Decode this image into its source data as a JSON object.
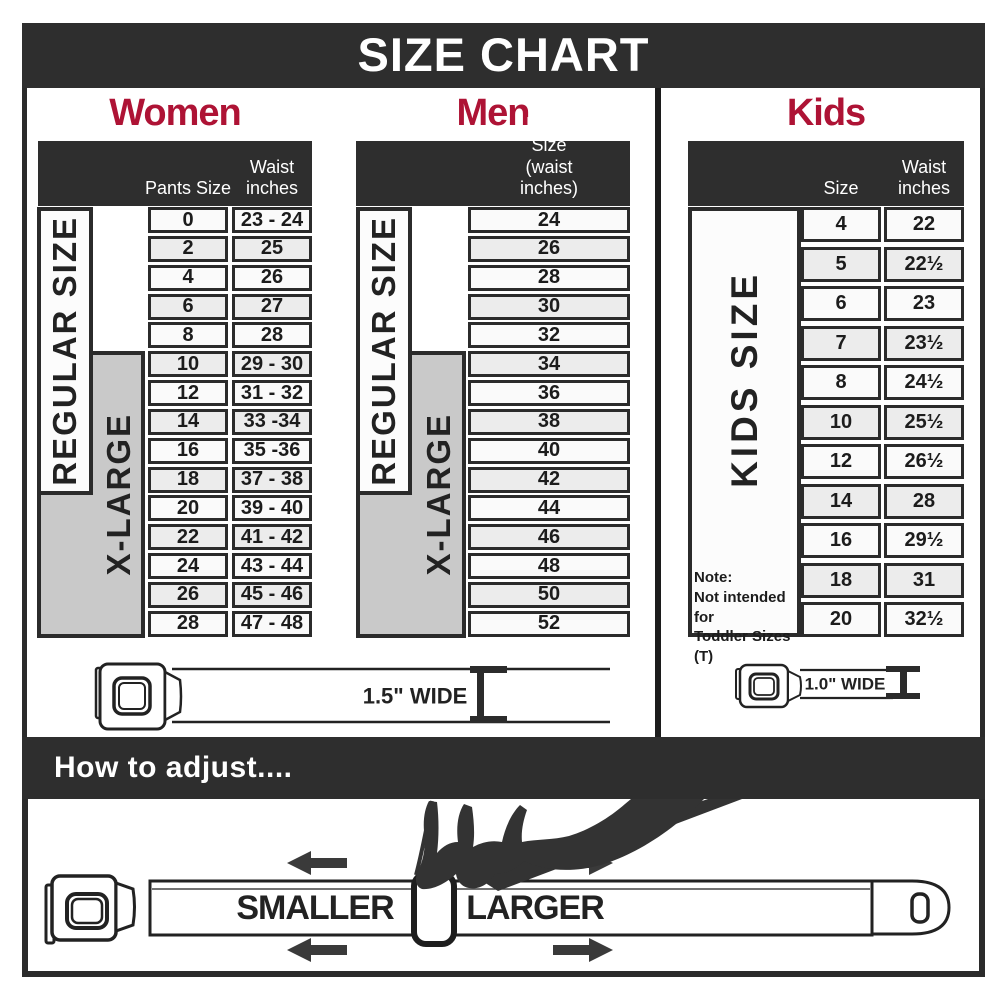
{
  "header": {
    "title": "SIZE CHART"
  },
  "colors": {
    "dark_bar": "#2e2e2e",
    "accent_red": "#ae1335",
    "row_shade": "#ececec",
    "row_light": "#fafafa",
    "xlarge_gray": "#c9c9c9"
  },
  "women": {
    "title": "Women",
    "col_pants_label": "Pants Size",
    "col_waist_label": "Waist\ninches",
    "regular_label": "REGULAR SIZE",
    "xlarge_label": "X-LARGE",
    "rows": [
      [
        "0",
        "23 - 24"
      ],
      [
        "2",
        "25"
      ],
      [
        "4",
        "26"
      ],
      [
        "6",
        "27"
      ],
      [
        "8",
        "28"
      ],
      [
        "10",
        "29 - 30"
      ],
      [
        "12",
        "31 - 32"
      ],
      [
        "14",
        "33 -34"
      ],
      [
        "16",
        "35 -36"
      ],
      [
        "18",
        "37 - 38"
      ],
      [
        "20",
        "39 - 40"
      ],
      [
        "22",
        "41 - 42"
      ],
      [
        "24",
        "43 - 44"
      ],
      [
        "26",
        "45 - 46"
      ],
      [
        "28",
        "47 - 48"
      ]
    ],
    "belt_width_label": "1.5\" WIDE"
  },
  "men": {
    "title": "Men",
    "col_label": "Pants Size\n(waist inches)",
    "regular_label": "REGULAR SIZE",
    "xlarge_label": "X-LARGE",
    "rows": [
      "24",
      "26",
      "28",
      "30",
      "32",
      "34",
      "36",
      "38",
      "40",
      "42",
      "44",
      "46",
      "48",
      "50",
      "52"
    ]
  },
  "kids": {
    "title": "Kids",
    "col_size_label": "Size",
    "col_waist_label": "Waist\ninches",
    "side_label": "KIDS SIZE",
    "note": "Note:\nNot intended for\nToddler Sizes (T)",
    "rows": [
      [
        "4",
        "22"
      ],
      [
        "5",
        "22½"
      ],
      [
        "6",
        "23"
      ],
      [
        "7",
        "23½"
      ],
      [
        "8",
        "24½"
      ],
      [
        "10",
        "25½"
      ],
      [
        "12",
        "26½"
      ],
      [
        "14",
        "28"
      ],
      [
        "16",
        "29½"
      ],
      [
        "18",
        "31"
      ],
      [
        "20",
        "32½"
      ]
    ],
    "belt_width_label": "1.0\" WIDE"
  },
  "adjust": {
    "heading": "How to adjust....",
    "smaller_label": "SMALLER",
    "larger_label": "LARGER"
  }
}
